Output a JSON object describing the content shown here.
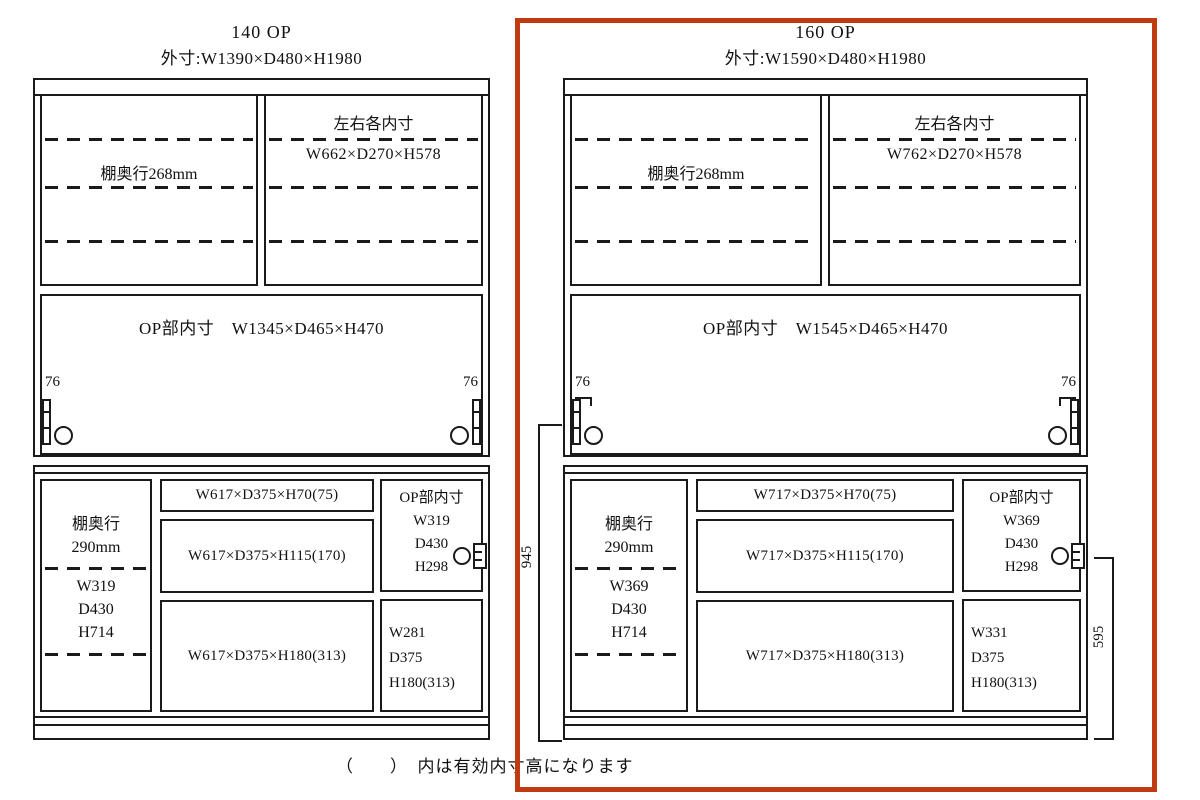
{
  "caption": "（　　）　内は有効内寸高になります",
  "highlight_color": "#c23a12",
  "cabinets": {
    "c140": {
      "title": "140 OP",
      "subtitle": "外寸:W1390×D480×H1980",
      "upper": {
        "shelf_depth": "棚奥行268mm",
        "inner_title": "左右各内寸",
        "inner_dims": "W662×D270×H578",
        "op_dims": "OP部内寸　W1345×D465×H470",
        "gap_left": "76",
        "gap_right": "76"
      },
      "lower": {
        "shelf_line1": "棚奥行",
        "shelf_line2": "290mm",
        "shelf_w": "W319",
        "shelf_d": "D430",
        "shelf_h": "H714",
        "drawer_top": "W617×D375×H70(75)",
        "drawer_middle": "W617×D375×H115(170)",
        "drawer_bottom": "W617×D375×H180(313)",
        "op_title": "OP部内寸",
        "op_w": "W319",
        "op_d": "D430",
        "op_h": "H298",
        "corner_w": "W281",
        "corner_d": "D375",
        "corner_h": "H180(313)"
      }
    },
    "c160": {
      "title": "160 OP",
      "subtitle": "外寸:W1590×D480×H1980",
      "upper": {
        "shelf_depth": "棚奥行268mm",
        "inner_title": "左右各内寸",
        "inner_dims": "W762×D270×H578",
        "op_dims": "OP部内寸　W1545×D465×H470",
        "gap_left": "76",
        "gap_right": "76"
      },
      "lower": {
        "shelf_line1": "棚奥行",
        "shelf_line2": "290mm",
        "shelf_w": "W369",
        "shelf_d": "D430",
        "shelf_h": "H714",
        "drawer_top": "W717×D375×H70(75)",
        "drawer_middle": "W717×D375×H115(170)",
        "drawer_bottom": "W717×D375×H180(313)",
        "op_title": "OP部内寸",
        "op_w": "W369",
        "op_d": "D430",
        "op_h": "H298",
        "corner_w": "W331",
        "corner_d": "D375",
        "corner_h": "H180(313)"
      },
      "annotations": {
        "overall_height": "945",
        "lower_height": "595"
      }
    }
  }
}
